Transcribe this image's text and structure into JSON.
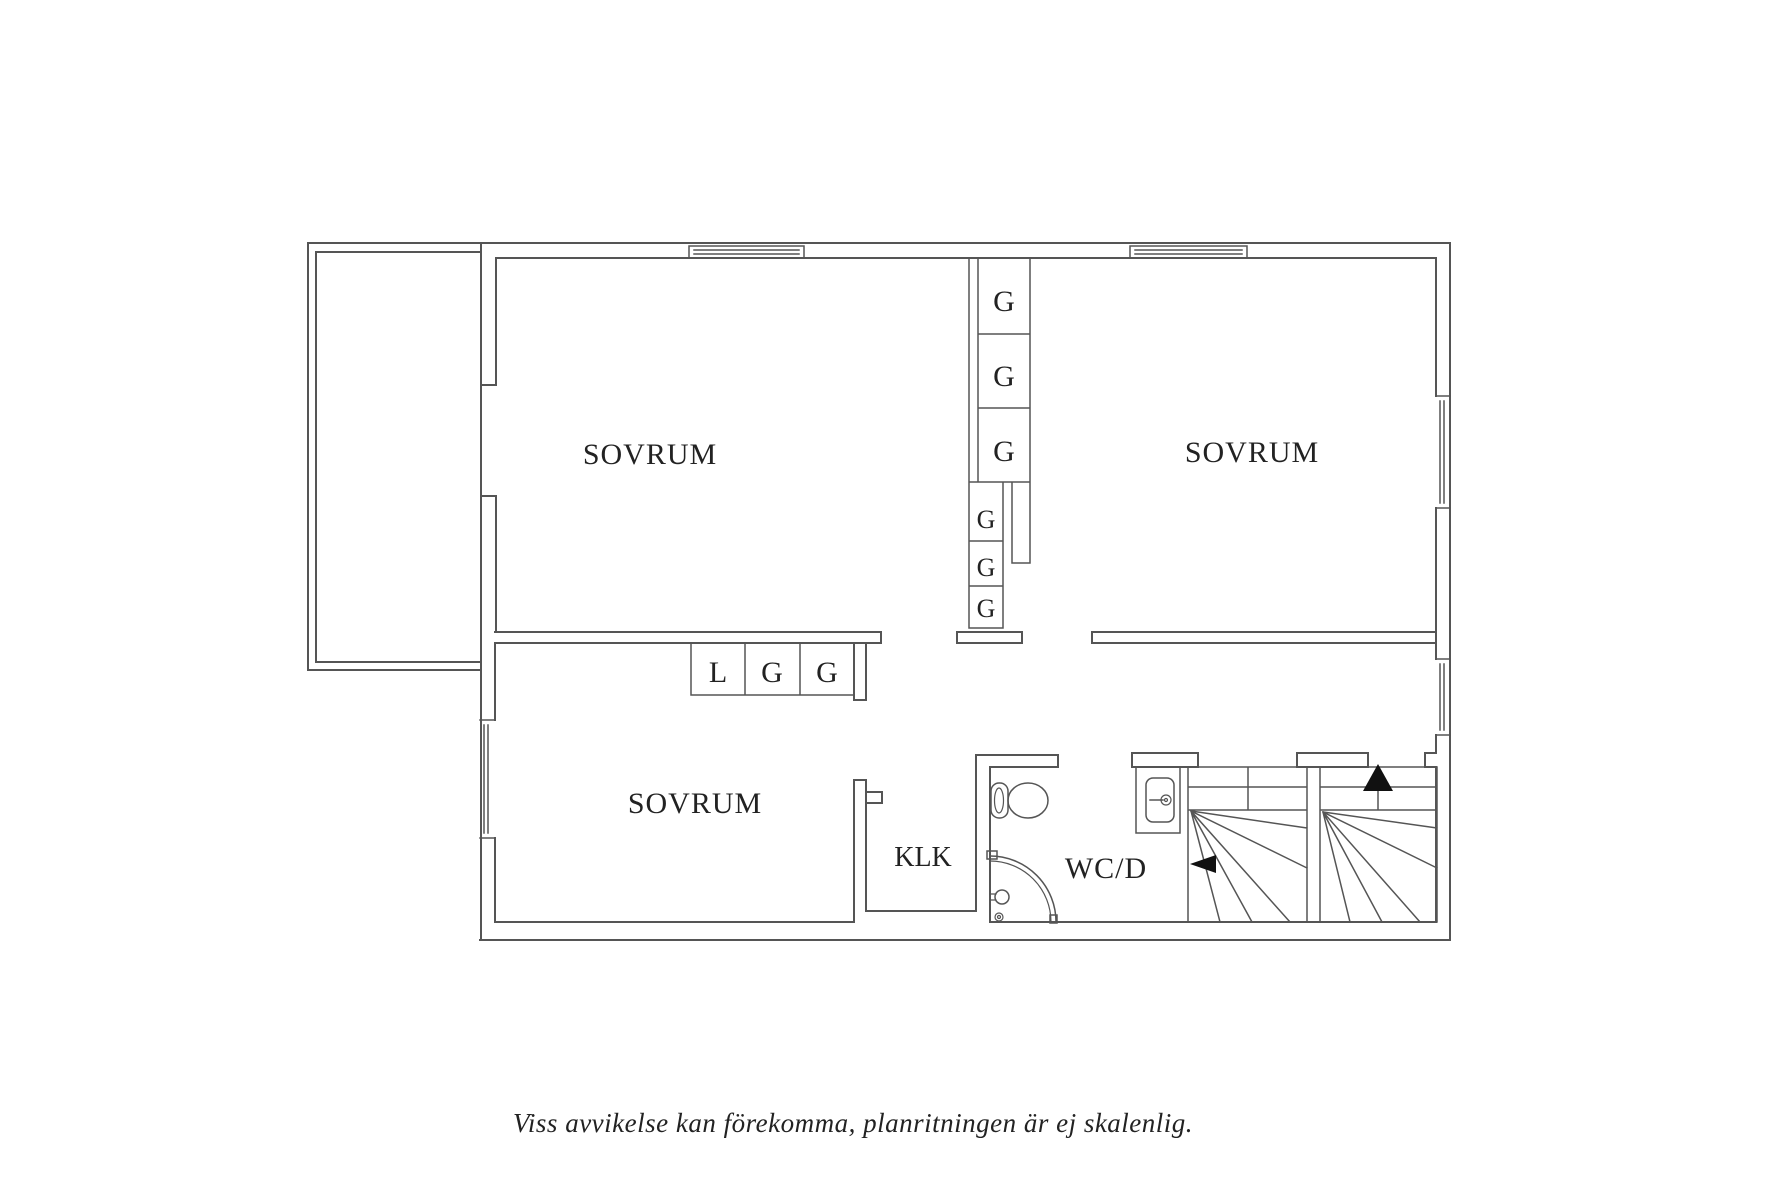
{
  "colors": {
    "background": "#ffffff",
    "line": "#555555",
    "text": "#222222",
    "arrow": "#111111"
  },
  "rooms": [
    {
      "id": "bedroom-top-left",
      "label": "SOVRUM"
    },
    {
      "id": "bedroom-top-right",
      "label": "SOVRUM"
    },
    {
      "id": "bedroom-bottom-left",
      "label": "SOVRUM"
    },
    {
      "id": "closet-klk",
      "label": "KLK"
    },
    {
      "id": "bath-wc-shower",
      "label": "WC/D"
    }
  ],
  "closets": {
    "tall_column": [
      "G",
      "G",
      "G",
      "G",
      "G",
      "G"
    ],
    "row": [
      "L",
      "G",
      "G"
    ]
  },
  "stairs": {
    "up_arrow": "up",
    "down_arrow": "left"
  },
  "caption": "Viss avvikelse kan förekomma, planritningen är ej skalenlig."
}
